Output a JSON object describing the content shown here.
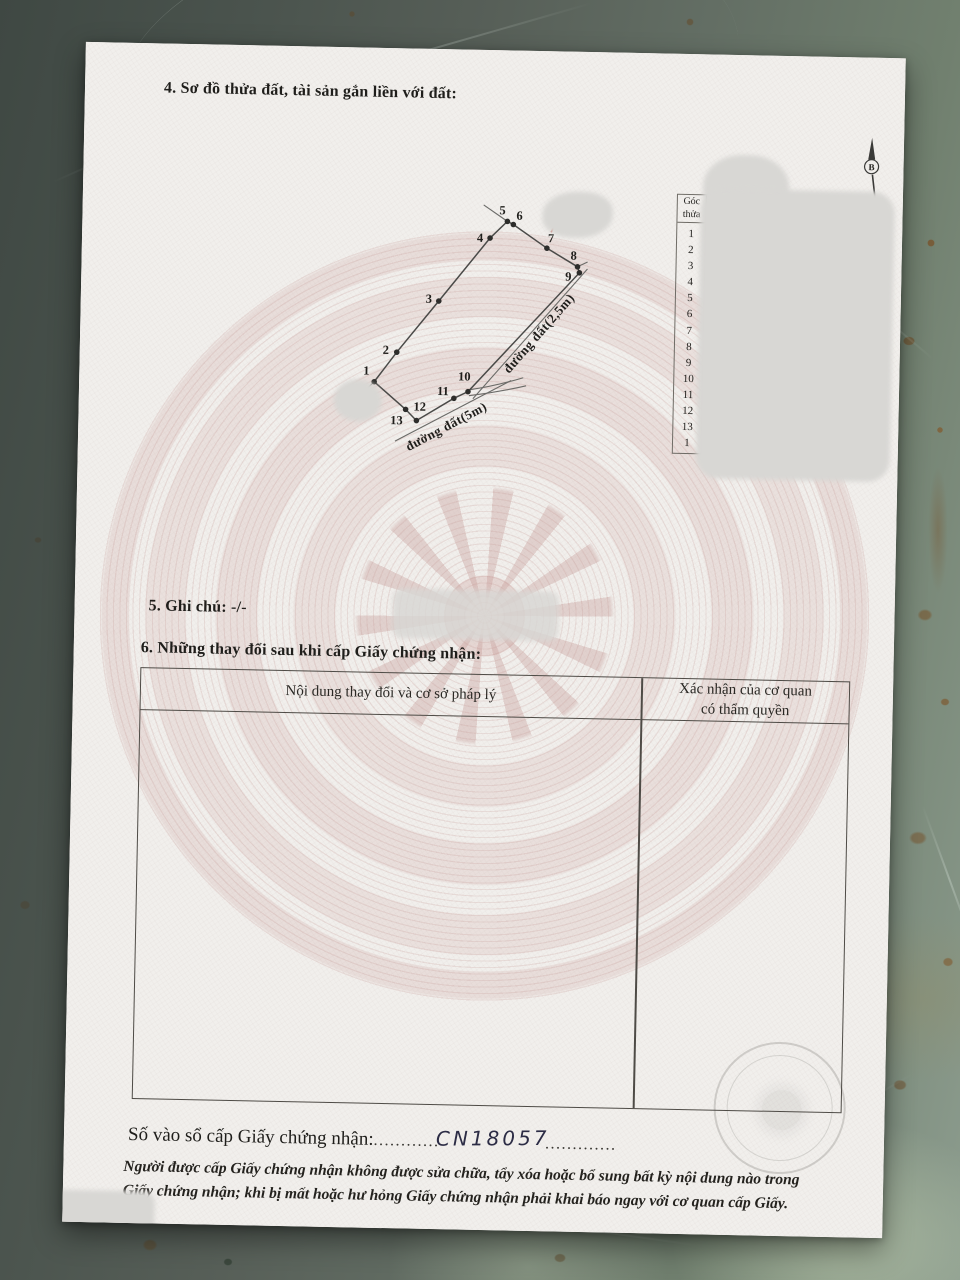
{
  "document": {
    "section4_title": "4. Sơ đồ thửa đất, tài sản gắn liền với đất:",
    "section5_title": "5. Ghi chú: -/-",
    "section6_title": "6. Những thay đổi sau khi cấp Giấy chứng nhận:"
  },
  "diagram": {
    "north_label": "B",
    "road_25_label": "đường đất(2,5m)",
    "road_5_label": "đường đất(5m)",
    "points": [
      {
        "label": "1",
        "x": 295,
        "y": 334,
        "lx": 287,
        "ly": 327
      },
      {
        "label": "2",
        "x": 317,
        "y": 304,
        "lx": 306,
        "ly": 306
      },
      {
        "label": "3",
        "x": 358,
        "y": 252,
        "lx": 348,
        "ly": 254
      },
      {
        "label": "4",
        "x": 408,
        "y": 188,
        "lx": 398,
        "ly": 192
      },
      {
        "label": "5",
        "x": 425,
        "y": 171,
        "lx": 420,
        "ly": 164
      },
      {
        "label": "6",
        "x": 431,
        "y": 174,
        "lx": 437,
        "ly": 169
      },
      {
        "label": "7",
        "x": 465,
        "y": 197,
        "lx": 469,
        "ly": 191
      },
      {
        "label": "8",
        "x": 496,
        "y": 215,
        "lx": 492,
        "ly": 208
      },
      {
        "label": "9",
        "x": 498,
        "y": 221,
        "lx": 487,
        "ly": 229
      },
      {
        "label": "10",
        "x": 389,
        "y": 342,
        "lx": 385,
        "ly": 331
      },
      {
        "label": "11",
        "x": 375,
        "y": 349,
        "lx": 364,
        "ly": 346
      },
      {
        "label": "12",
        "x": 338,
        "y": 372,
        "lx": 341,
        "ly": 362
      },
      {
        "label": "13",
        "x": 327,
        "y": 361,
        "lx": 318,
        "ly": 376
      }
    ]
  },
  "corner_table": {
    "header_line1": "Góc",
    "header_line2": "thửa",
    "rows": [
      "1",
      "2",
      "3",
      "4",
      "5",
      "6",
      "7",
      "8",
      "9",
      "10",
      "11",
      "12",
      "13",
      "1"
    ]
  },
  "changes_table": {
    "col1_header": "Nội dung thay đổi và cơ sở pháp lý",
    "col2_header_line1": "Xác nhận của cơ quan",
    "col2_header_line2": "có thẩm quyền"
  },
  "footer": {
    "serial_label": "Số vào sổ cấp Giấy chứng nhận:",
    "serial_dots_left": "............",
    "serial_value": "CN18057",
    "serial_dots_right": ".............",
    "legal_line1": "Người được cấp Giấy chứng nhận không được sửa chữa, tẩy xóa hoặc bổ sung bất kỳ nội dung nào trong",
    "legal_line2": "Giấy chứng nhận; khi bị mất hoặc hư hỏng Giấy chứng nhận phải khai báo ngay với cơ quan cấp Giấy."
  },
  "colors": {
    "ink": "#1f1e1b",
    "paper": "#f1efec",
    "blob": "#d8d7d4",
    "accent_red": "#c0392b",
    "hand": "#2c2c45",
    "line": "#6f6c66",
    "tline": "#4e4b46"
  }
}
